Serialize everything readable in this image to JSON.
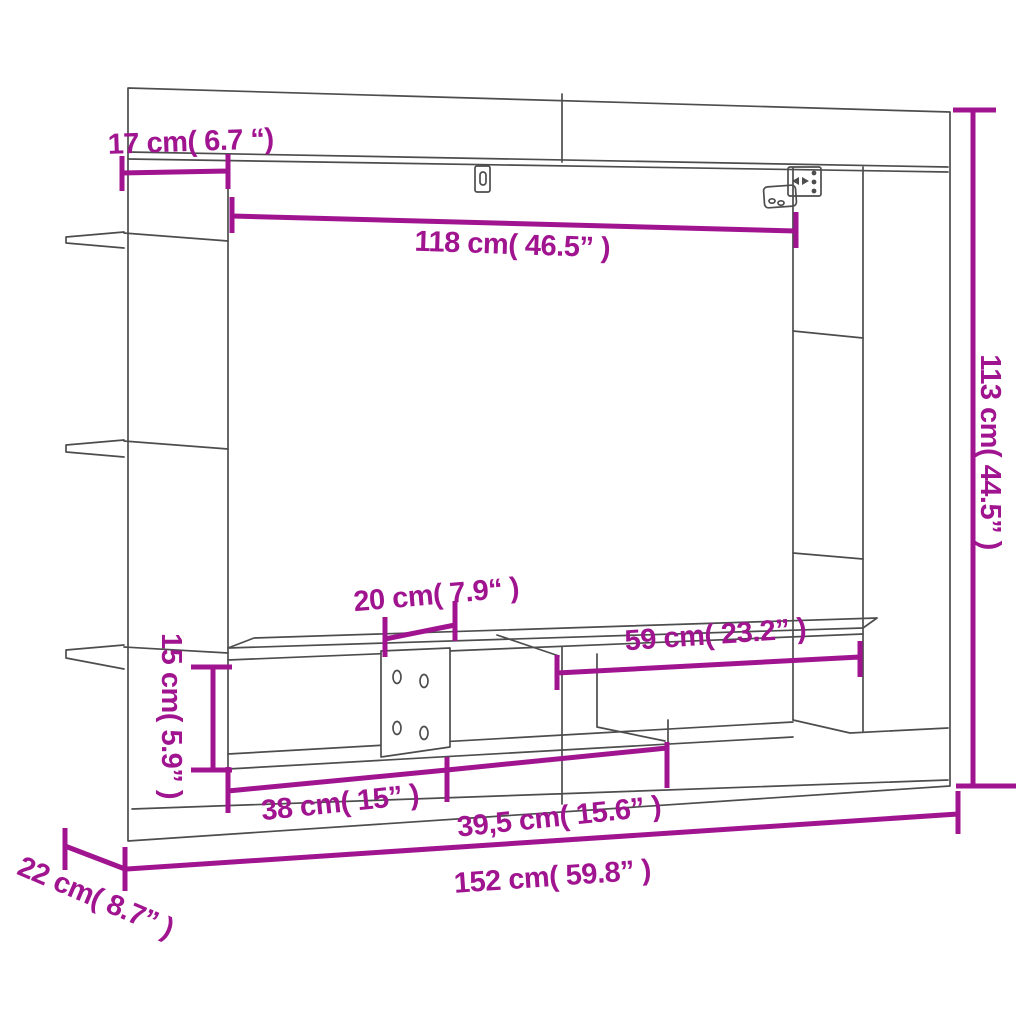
{
  "figure": {
    "accent_color": "#a01490",
    "outline_color": "#4d4d4d",
    "background_color": "#ffffff"
  },
  "dimensions": {
    "top_offset": {
      "label": "17 cm( 6.7 “)"
    },
    "inner_width": {
      "label": "118 cm( 46.5” )"
    },
    "overall_height": {
      "label": "113 cm( 44.5” )"
    },
    "bracket_width": {
      "label": "20 cm( 7.9“ )"
    },
    "right_shelf_width": {
      "label": "59 cm( 23.2” )"
    },
    "bench_height": {
      "label": "15 cm( 5.9” )"
    },
    "left_compartment_width": {
      "label": "38 cm( 15” )"
    },
    "middle_compartment_width": {
      "label": "39,5 cm( 15.6” )"
    },
    "overall_width": {
      "label": "152 cm( 59.8” )"
    },
    "depth": {
      "label": "22 cm( 8.7” )"
    }
  }
}
